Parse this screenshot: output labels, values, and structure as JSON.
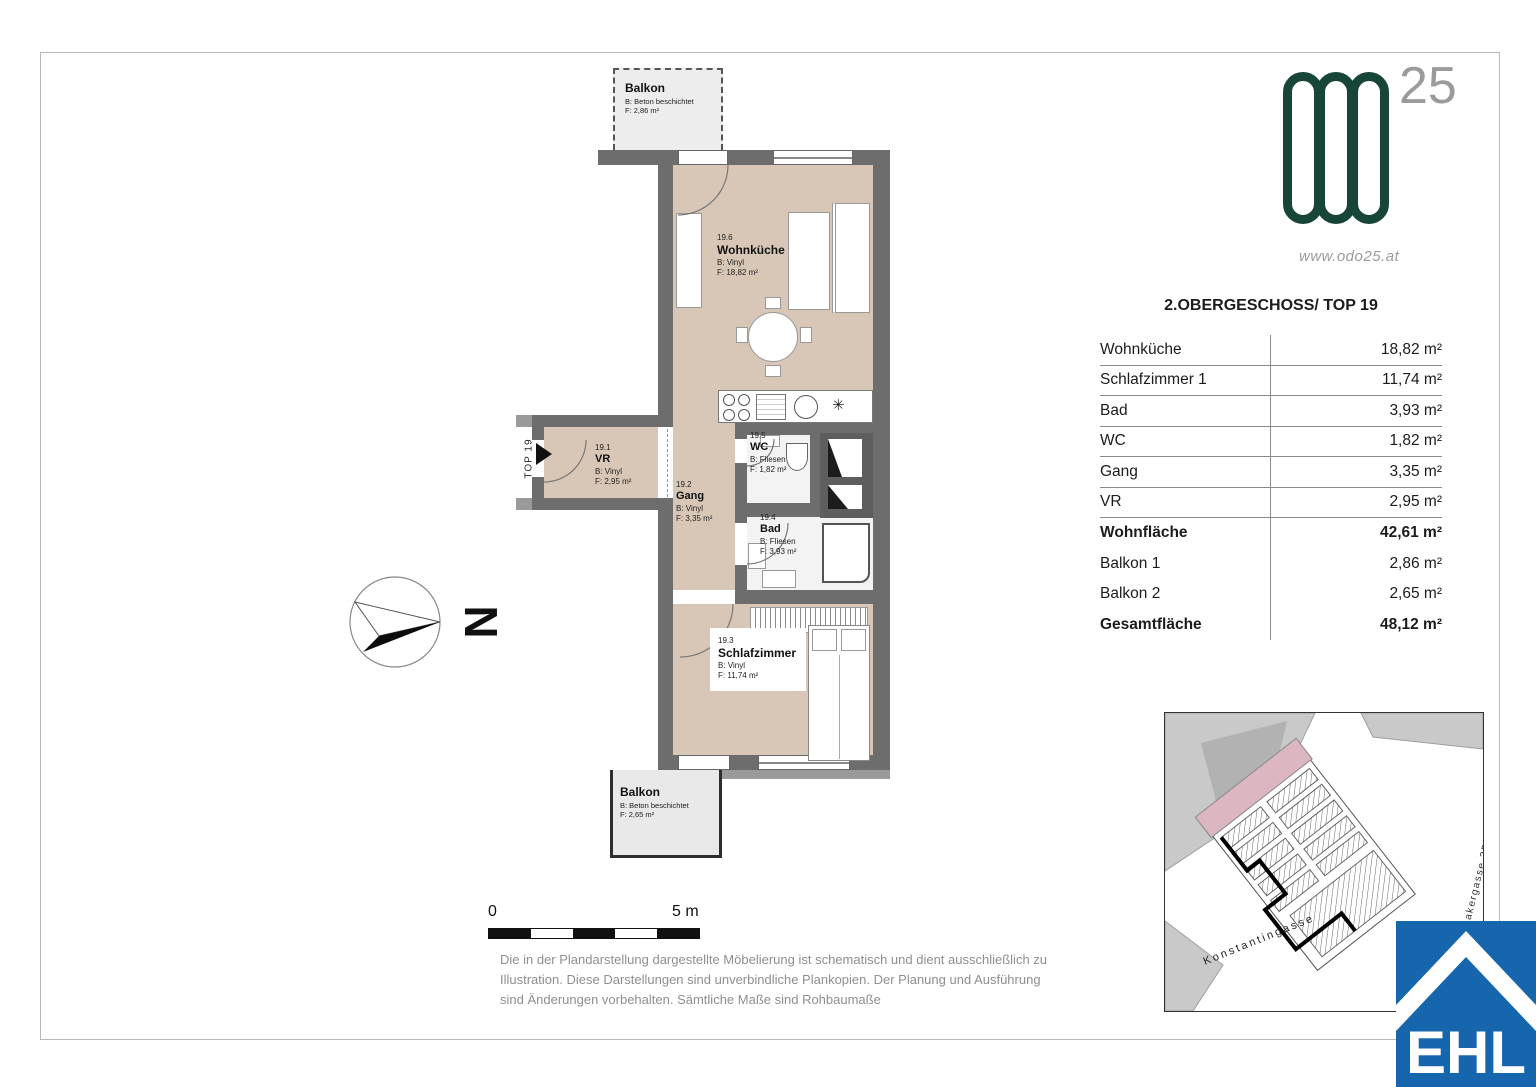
{
  "header_logo": {
    "numeral": "25",
    "website": "www.odo25.at"
  },
  "area_table": {
    "title": "2.OBERGESCHOSS/ TOP 19",
    "rows": [
      {
        "label": "Wohnküche",
        "value": "18,82 m²"
      },
      {
        "label": "Schlafzimmer 1",
        "value": "11,74 m²"
      },
      {
        "label": "Bad",
        "value": "3,93 m²"
      },
      {
        "label": "WC",
        "value": "1,82 m²"
      },
      {
        "label": "Gang",
        "value": "3,35 m²"
      },
      {
        "label": "VR",
        "value": "2,95 m²"
      },
      {
        "label": "Wohnfläche",
        "value": "42,61 m²"
      },
      {
        "label": "Balkon 1",
        "value": "2,86 m²"
      },
      {
        "label": "Balkon 2",
        "value": "2,65 m²"
      },
      {
        "label": "Gesamtfläche",
        "value": "48,12 m²"
      }
    ]
  },
  "floorplan": {
    "balcony_top": {
      "name": "Balkon",
      "finish": "B: Beton beschichtet",
      "area": "F: 2,86 m²"
    },
    "balcony_bottom": {
      "name": "Balkon",
      "finish": "B: Beton beschichtet",
      "area": "F: 2,65 m²"
    },
    "rooms": [
      {
        "num": "19.6",
        "name": "Wohnküche",
        "finish": "B: Vinyl",
        "area": "F: 18,82 m²"
      },
      {
        "num": "19.1",
        "name": "VR",
        "finish": "B: Vinyl",
        "area": "F: 2,95 m²"
      },
      {
        "num": "19.2",
        "name": "Gang",
        "finish": "B: Vinyl",
        "area": "F: 3,35 m²"
      },
      {
        "num": "19.5",
        "name": "WC",
        "finish": "B: Fliesen",
        "area": "F: 1,82 m²"
      },
      {
        "num": "19.4",
        "name": "Bad",
        "finish": "B: Fliesen",
        "area": "F: 3,93 m²"
      },
      {
        "num": "19.3",
        "name": "Schlafzimmer",
        "finish": "B: Vinyl",
        "area": "F: 11,74 m²"
      }
    ],
    "entrance_label": "TOP 19",
    "north_label": "N",
    "kitchen_symbol": "✳"
  },
  "scale_bar": {
    "start": "0",
    "end": "5 m"
  },
  "disclaimer": {
    "lines": [
      "Die in der Plandarstellung dargestellte Möbelierung ist schematisch und dient ausschließlich zu",
      "Illustration. Diese Darstellungen sind unverbindliche Plankopien. Der Planung und Ausführung",
      "sind Änderungen vorbehalten. Sämtliche Maße sind Rohbaumaße"
    ]
  },
  "site_plan": {
    "street_bottom": "Konstantingasse",
    "street_right": "Odoakergasse 25"
  },
  "footer_logo": {
    "text": "EHL"
  },
  "colors": {
    "wall": "#6d6d6d",
    "floor_beige": "#d8c7b7",
    "brand_green": "#17453a",
    "ehl_blue": "#1566ac",
    "highlight_pink": "#dcb6c1"
  }
}
